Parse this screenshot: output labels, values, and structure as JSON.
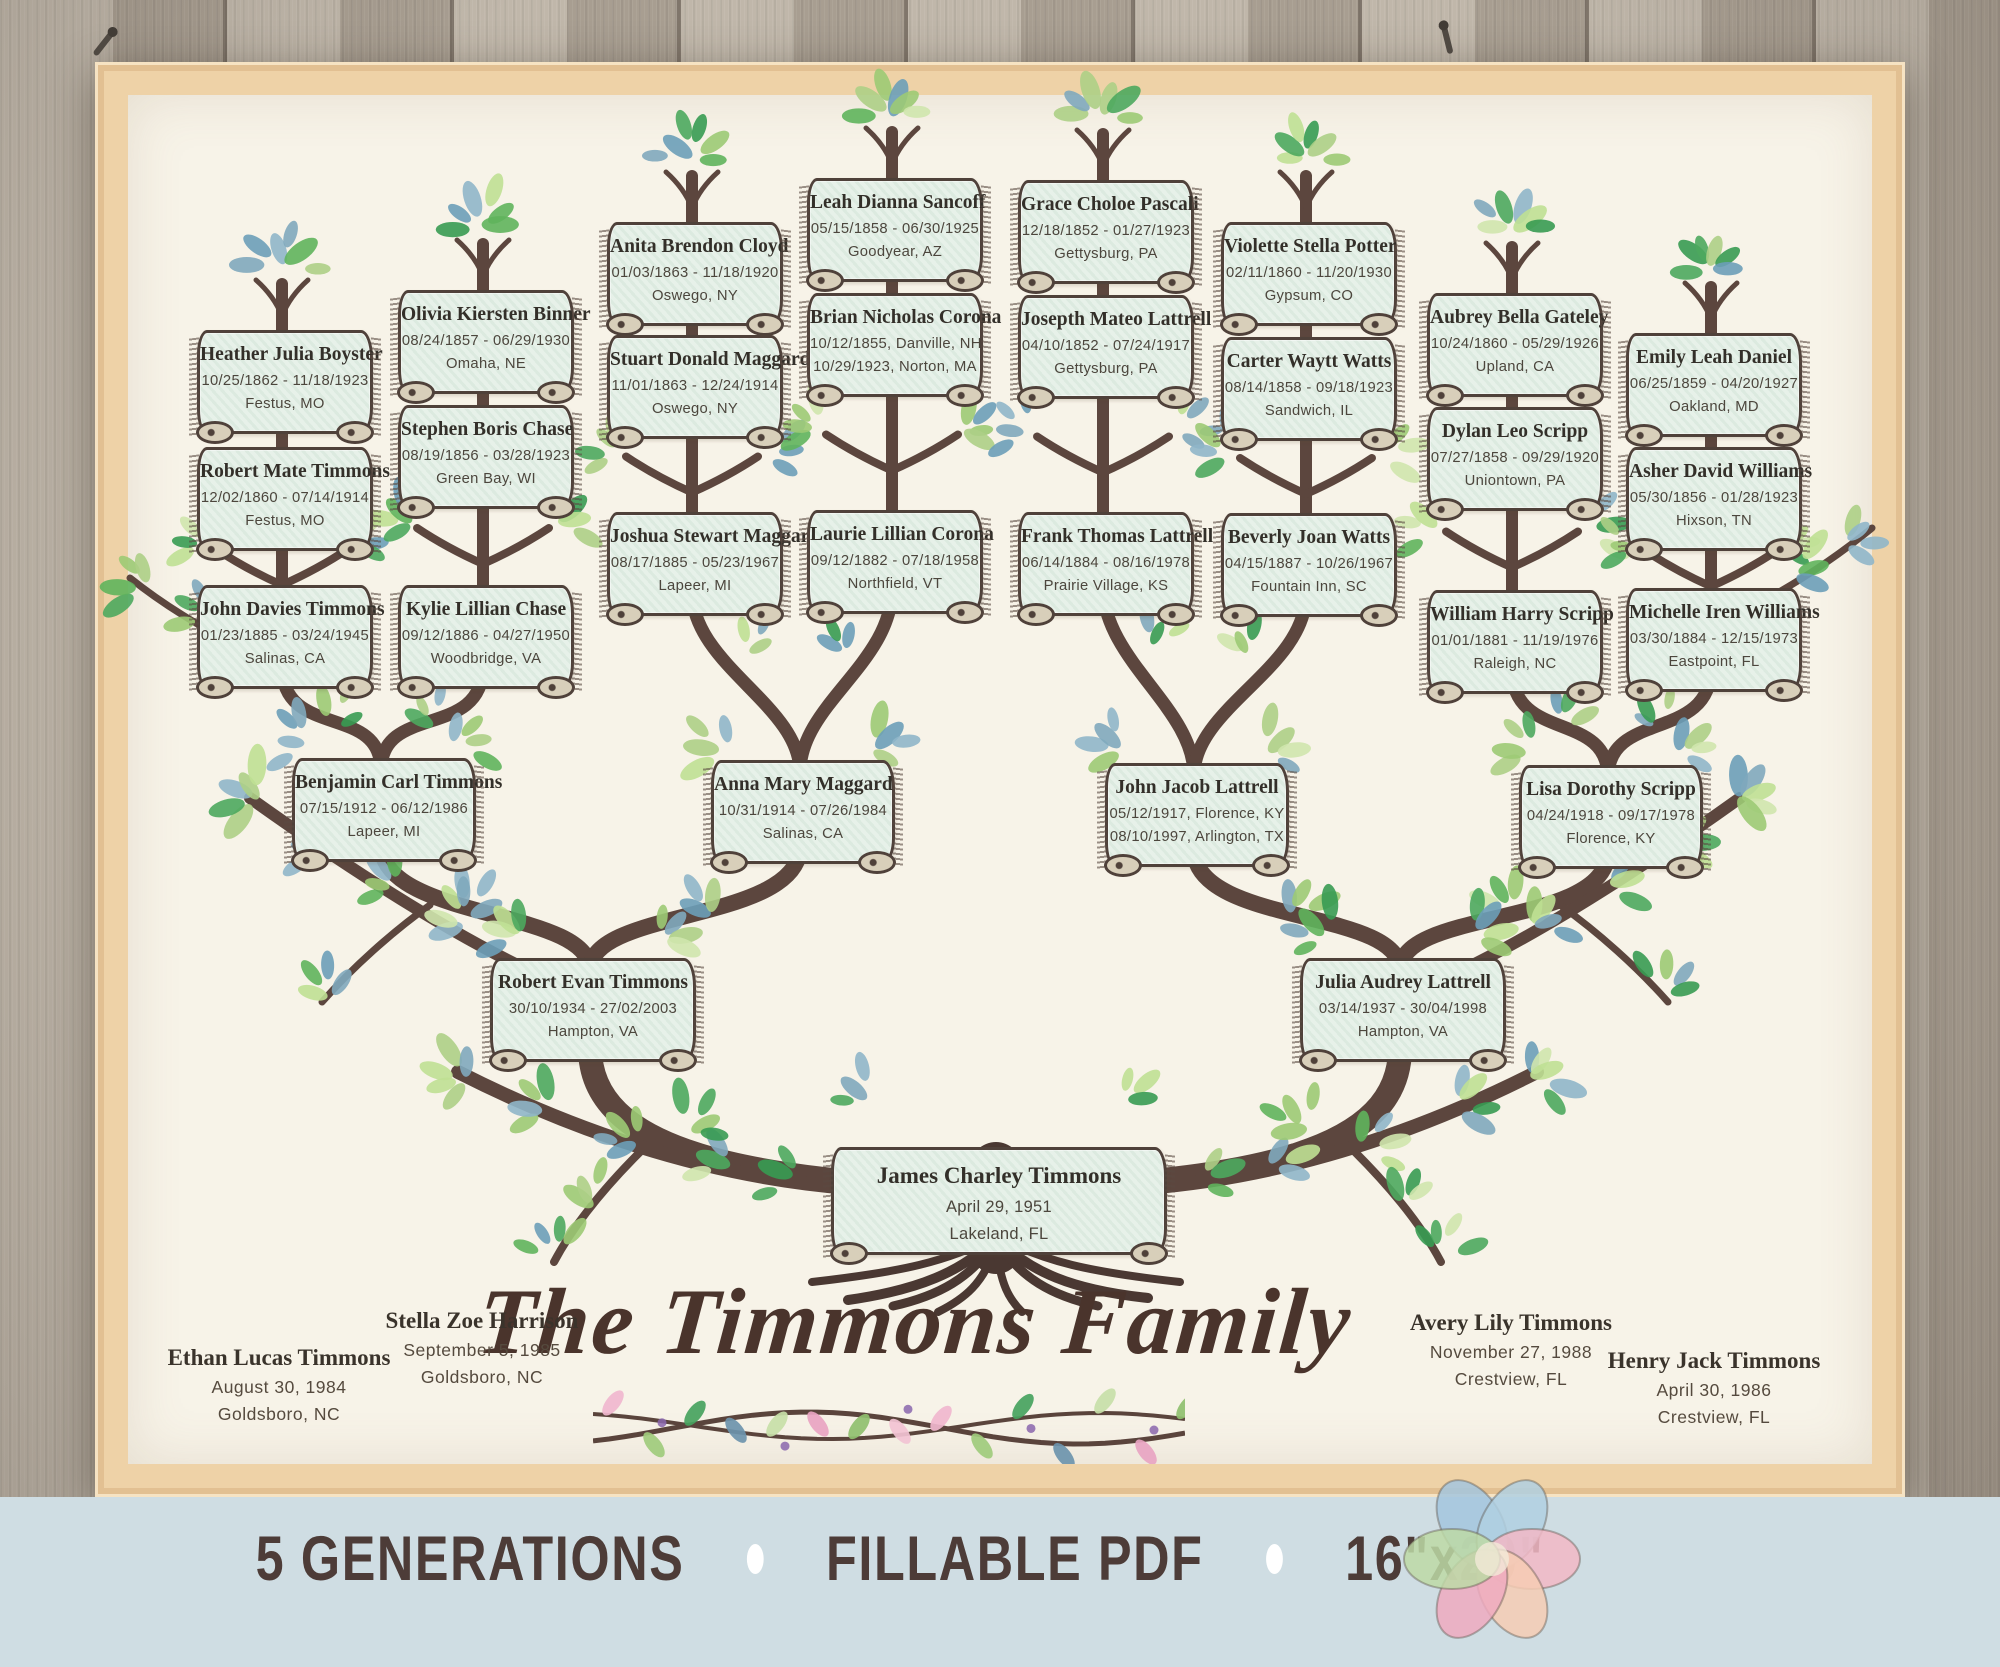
{
  "title": "The Timmons Family",
  "tree": {
    "root": {
      "name": "James Charley Timmons",
      "lines": [
        "April 29, 1951",
        "Lakeland, FL"
      ]
    },
    "generation2": [
      {
        "name": "Robert Evan Timmons",
        "lines": [
          "30/10/1934 - 27/02/2003",
          "Hampton, VA"
        ]
      },
      {
        "name": "Julia Audrey Lattrell",
        "lines": [
          "03/14/1937 - 30/04/1998",
          "Hampton, VA"
        ]
      }
    ],
    "generation3": [
      {
        "name": "Benjamin Carl Timmons",
        "lines": [
          "07/15/1912 - 06/12/1986",
          "Lapeer, MI"
        ]
      },
      {
        "name": "Anna Mary Maggard",
        "lines": [
          "10/31/1914 - 07/26/1984",
          "Salinas, CA"
        ]
      },
      {
        "name": "John Jacob Lattrell",
        "lines": [
          "05/12/1917, Florence, KY",
          "08/10/1997, Arlington, TX"
        ]
      },
      {
        "name": "Lisa Dorothy Scripp",
        "lines": [
          "04/24/1918 - 09/17/1978",
          "Florence, KY"
        ]
      }
    ],
    "generation4": [
      {
        "name": "John Davies Timmons",
        "lines": [
          "01/23/1885 - 03/24/1945",
          "Salinas, CA"
        ]
      },
      {
        "name": "Kylie Lillian Chase",
        "lines": [
          "09/12/1886 - 04/27/1950",
          "Woodbridge, VA"
        ]
      },
      {
        "name": "Joshua Stewart Maggard",
        "lines": [
          "08/17/1885 - 05/23/1967",
          "Lapeer, MI"
        ]
      },
      {
        "name": "Laurie Lillian Corona",
        "lines": [
          "09/12/1882 - 07/18/1958",
          "Northfield, VT"
        ]
      },
      {
        "name": "Frank Thomas Lattrell",
        "lines": [
          "06/14/1884 - 08/16/1978",
          "Prairie Village, KS"
        ]
      },
      {
        "name": "Beverly Joan Watts",
        "lines": [
          "04/15/1887 - 10/26/1967",
          "Fountain Inn, SC"
        ]
      },
      {
        "name": "William Harry Scripp",
        "lines": [
          "01/01/1881 - 11/19/1976",
          "Raleigh, NC"
        ]
      },
      {
        "name": "Michelle Iren Williams",
        "lines": [
          "03/30/1884 - 12/15/1973",
          "Eastpoint, FL"
        ]
      }
    ],
    "generation5": [
      {
        "name": "Heather Julia Boyster",
        "lines": [
          "10/25/1862 - 11/18/1923",
          "Festus, MO"
        ]
      },
      {
        "name": "Robert Mate Timmons",
        "lines": [
          "12/02/1860 - 07/14/1914",
          "Festus, MO"
        ]
      },
      {
        "name": "Olivia Kiersten Binner",
        "lines": [
          "08/24/1857 - 06/29/1930",
          "Omaha, NE"
        ]
      },
      {
        "name": "Stephen Boris Chase",
        "lines": [
          "08/19/1856 - 03/28/1923",
          "Green Bay, WI"
        ]
      },
      {
        "name": "Anita Brendon Cloyd",
        "lines": [
          "01/03/1863 - 11/18/1920",
          "Oswego, NY"
        ]
      },
      {
        "name": "Stuart Donald Maggard",
        "lines": [
          "11/01/1863 - 12/24/1914",
          "Oswego, NY"
        ]
      },
      {
        "name": "Leah Dianna Sancoff",
        "lines": [
          "05/15/1858 - 06/30/1925",
          "Goodyear, AZ"
        ]
      },
      {
        "name": "Brian Nicholas Corona",
        "lines": [
          "10/12/1855, Danville, NH",
          "10/29/1923, Norton, MA"
        ]
      },
      {
        "name": "Grace Choloe Pascali",
        "lines": [
          "12/18/1852 - 01/27/1923",
          "Gettysburg, PA"
        ]
      },
      {
        "name": "Josepth Mateo Lattrell",
        "lines": [
          "04/10/1852 - 07/24/1917",
          "Gettysburg, PA"
        ]
      },
      {
        "name": "Violette Stella Potter",
        "lines": [
          "02/11/1860 - 11/20/1930",
          "Gypsum, CO"
        ]
      },
      {
        "name": "Carter Waytt Watts",
        "lines": [
          "08/14/1858 - 09/18/1923",
          "Sandwich, IL"
        ]
      },
      {
        "name": "Aubrey Bella Gateley",
        "lines": [
          "10/24/1860 - 05/29/1926",
          "Upland, CA"
        ]
      },
      {
        "name": "Dylan Leo Scripp",
        "lines": [
          "07/27/1858 - 09/29/1920",
          "Uniontown, PA"
        ]
      },
      {
        "name": "Emily Leah Daniel",
        "lines": [
          "06/25/1859 - 04/20/1927",
          "Oakland, MD"
        ]
      },
      {
        "name": "Asher David Williams",
        "lines": [
          "05/30/1856 - 01/28/1923",
          "Hixson, TN"
        ]
      }
    ],
    "children": [
      {
        "name": "Ethan Lucas Timmons",
        "lines": [
          "August 30, 1984",
          "Goldsboro, NC"
        ]
      },
      {
        "name": "Stella Zoe Harrison",
        "lines": [
          "September 5, 1985",
          "Goldsboro, NC"
        ]
      },
      {
        "name": "Avery Lily Timmons",
        "lines": [
          "November 27, 1988",
          "Crestview, FL"
        ]
      },
      {
        "name": "Henry Jack Timmons",
        "lines": [
          "April 30, 1986",
          "Crestview, FL"
        ]
      }
    ]
  },
  "footer": {
    "items": [
      "5 GENERATIONS",
      "FILLABLE PDF",
      "16\"x20\""
    ],
    "separator": "•"
  },
  "colors": {
    "paper": "#f7f3e8",
    "frame": "#eed2a7",
    "banner_fill": "#e7f1e9",
    "branch_brown": "#5c463e",
    "band_blue": "#cfdde3",
    "title_text": "#4a342c",
    "leaf_green": "#5fb45c",
    "leaf_blue": "#7fa8bd"
  }
}
